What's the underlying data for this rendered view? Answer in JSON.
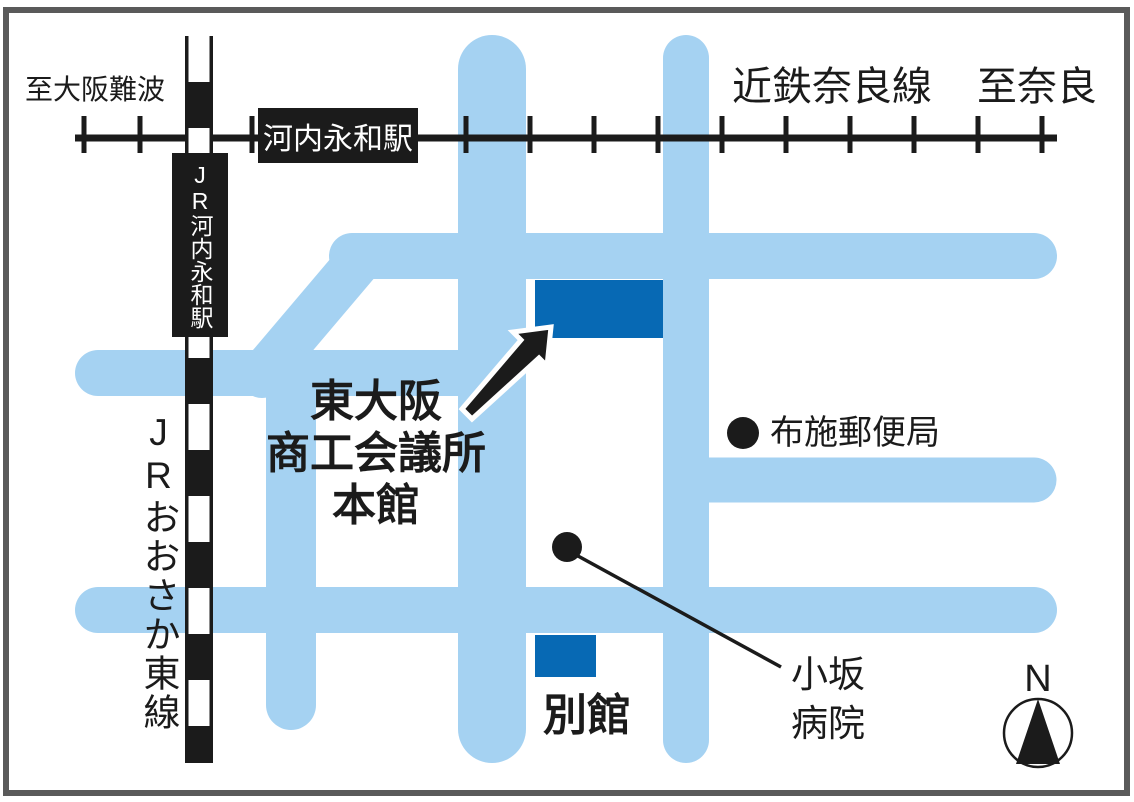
{
  "kintetsu": {
    "line_label": "近鉄奈良線",
    "to_left": "至大阪難波",
    "to_right": "至奈良",
    "station": "河内永和駅"
  },
  "jr": {
    "line_label": "JRおおさか東線",
    "station": "JR河内永和駅"
  },
  "buildings": {
    "main": {
      "line1": "東大阪",
      "line2": "商工会議所",
      "line3": "本館"
    },
    "annex": {
      "label": "別館"
    }
  },
  "pois": {
    "post_office": {
      "label": "布施郵便局"
    },
    "hospital": {
      "line1": "小坂",
      "line2": "病院"
    }
  },
  "compass": {
    "label": "N"
  },
  "colors": {
    "road": "#A5D2F2",
    "building": "#0769B4",
    "railway": "#1B1B1B",
    "frame": "#5A5A5A"
  }
}
